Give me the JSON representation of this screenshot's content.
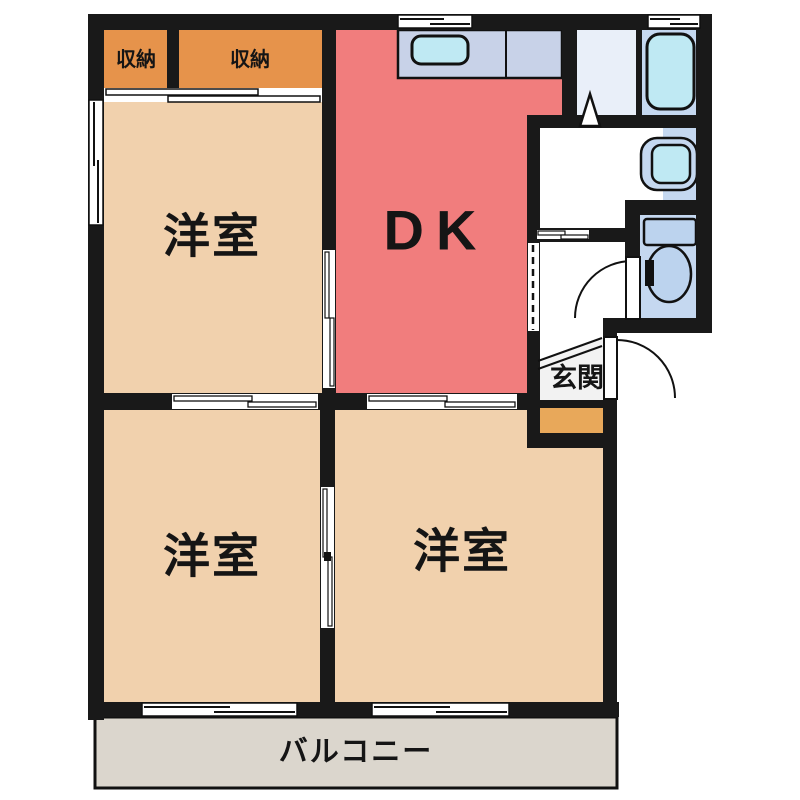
{
  "floorplan": {
    "type": "apartment-floor-plan",
    "rooms": {
      "closet_left": {
        "label": "収納",
        "color": "#E6934B"
      },
      "closet_right": {
        "label": "収納",
        "color": "#E6934B"
      },
      "dining_kitchen": {
        "label": "DK",
        "color": "#F17D7D"
      },
      "western_room_upper_left": {
        "label": "洋室",
        "color": "#F1D1AD"
      },
      "western_room_lower_left": {
        "label": "洋室",
        "color": "#F1D1AD"
      },
      "western_room_lower_right": {
        "label": "洋室",
        "color": "#F1D1AD"
      },
      "entrance": {
        "label": "玄関",
        "color": "#F2F2F2"
      },
      "balcony": {
        "label": "バルコニー",
        "color": "#DBD6CD"
      },
      "washroom": {
        "color": "#E9EFF9"
      },
      "bathroom": {
        "color": "#C5D8F0"
      },
      "toilet_room": {
        "color": "#C5D8F0"
      }
    },
    "fixtures": {
      "kitchen_counter": {
        "name": "kitchen-counter",
        "color": "#C8D2E8"
      },
      "kitchen_sink": {
        "name": "kitchen-sink",
        "color": "#BFE9F3"
      },
      "bathtub": {
        "name": "bathtub",
        "color": "#BFE9F3"
      },
      "washbasin": {
        "name": "washbasin",
        "color": "#BFE9F3"
      },
      "toilet": {
        "name": "toilet",
        "color": "#BCD3EE"
      },
      "shoe_cabinet": {
        "name": "shoe-cabinet",
        "color": "#E8A85A"
      }
    },
    "colors": {
      "wall": "#191919",
      "door_window": "#FFFFFF",
      "outline": "#111111"
    }
  }
}
